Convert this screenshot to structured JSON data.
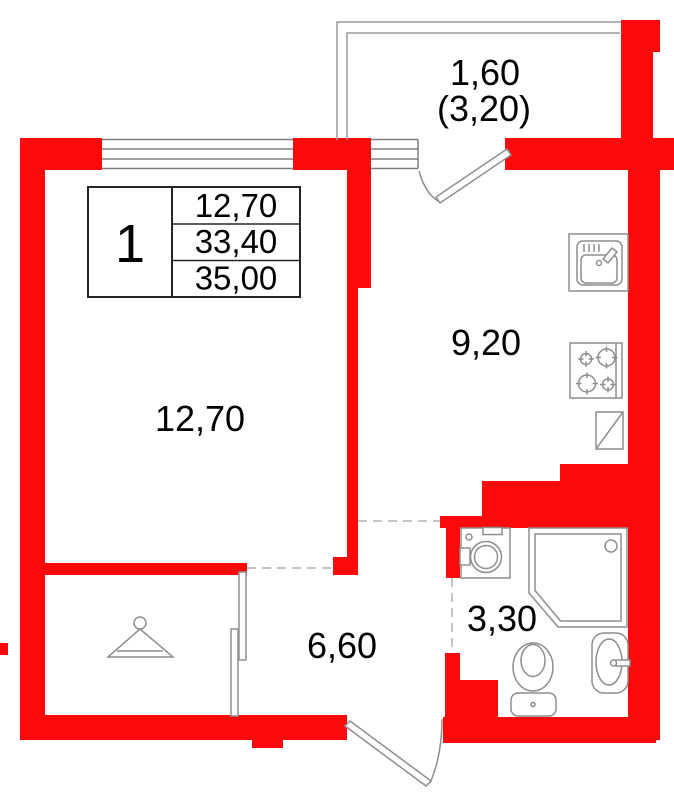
{
  "colors": {
    "wall": "#fa0a0a",
    "fixture_line": "#8e8e8e",
    "text": "#000000"
  },
  "info_table": {
    "unit_number": "1",
    "rows": [
      "12,70",
      "33,40",
      "35,00"
    ]
  },
  "rooms": {
    "living": {
      "area": "12,70"
    },
    "kitchen": {
      "area": "9,20"
    },
    "hall": {
      "area": "6,60"
    },
    "bathroom": {
      "area": "3,30"
    },
    "balcony": {
      "area": "1,60",
      "area_total": "(3,20)"
    }
  }
}
